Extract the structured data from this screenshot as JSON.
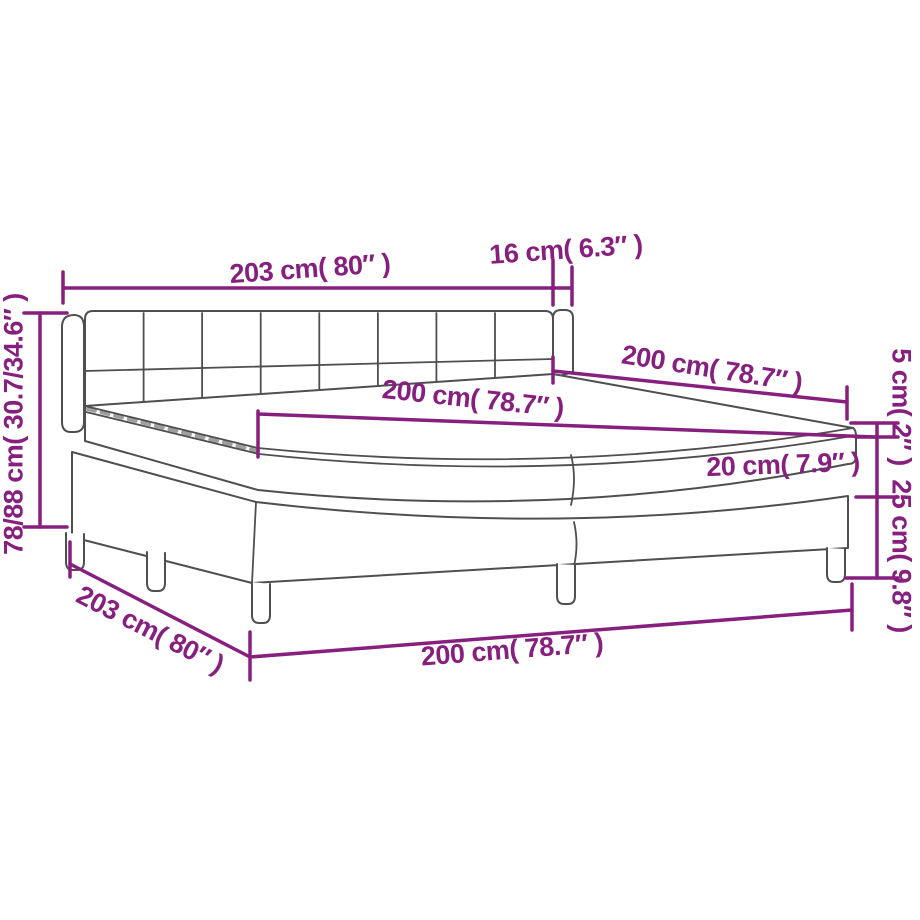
{
  "page": {
    "title": "Box spring bed dimension diagram"
  },
  "colors": {
    "dimension_accent": "#871f7f",
    "line_art": "#4f4f4f",
    "background": "#ffffff"
  },
  "dimensions": {
    "headboard_width": "203 cm( 80″ )",
    "headboard_side_depth": "16 cm( 6.3″ )",
    "bed_length_top": "200 cm( 78.7″ )",
    "mattress_length": "200 cm( 78.7″ )",
    "headboard_height": "78/88 cm( 30.7/34.6″ )",
    "topper_thickness": "5 cm( 2″ )",
    "mattress_thickness": "20 cm( 7.9″ )",
    "base_height": "25 cm( 9.8″ )",
    "base_width": "203 cm( 80″ )",
    "base_length": "200 cm( 78.7″ )"
  }
}
